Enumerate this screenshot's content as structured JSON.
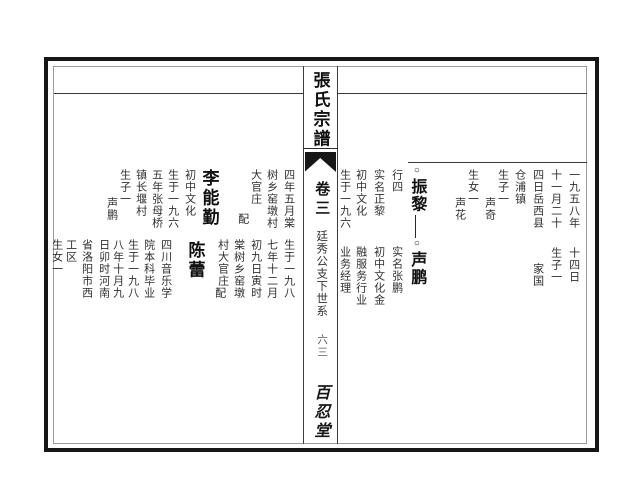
{
  "spine": {
    "title": "張氏宗譜",
    "volume": "卷三",
    "section": "廷秀公支下世系",
    "page_number": "六三",
    "hall": "百忍堂"
  },
  "right_page": {
    "top_row": {
      "carryover": [
        "一九五八年",
        "十一月二十",
        "四日岳西县",
        "仓浦镇"
      ],
      "children": [
        {
          "label": "生子一",
          "name": "声奇"
        },
        {
          "label": "生女一",
          "name": "声花"
        }
      ],
      "person": {
        "marker": "○",
        "name": "振黎",
        "notes": [
          "行四",
          "实名正黎",
          "初中文化",
          "生于一九六"
        ]
      }
    },
    "bottom_row": {
      "carryover": [
        "十四日"
      ],
      "children": [
        {
          "label": "生子一",
          "name": "家国"
        }
      ],
      "person": {
        "marker": "○",
        "name": "声鹏",
        "notes": [
          "实名张鹏",
          "初中文化金",
          "融服务行业",
          "业务经理"
        ]
      }
    }
  },
  "left_page": {
    "top_row": {
      "carryover": [
        "四年五月棠",
        "树乡窑墩村",
        "大官庄"
      ],
      "spouse_label": "配",
      "spouse": "李能勤",
      "notes": [
        "初中文化",
        "生于一九六",
        "五年张母桥",
        "镇长堰村",
        "生子一"
      ],
      "child": "声鹏"
    },
    "bottom_row": {
      "carryover": [
        "生于一九八",
        "七年十二月",
        "初九日寅时",
        "棠树乡窑墩",
        "村大官庄"
      ],
      "spouse_label": "配",
      "spouse": "陈蕾",
      "notes": [
        "四川音乐学",
        "院本科毕业",
        "生于一九八",
        "八年十月九",
        "日卯时河南",
        "省洛阳市西",
        "工区",
        "生女一"
      ]
    }
  }
}
